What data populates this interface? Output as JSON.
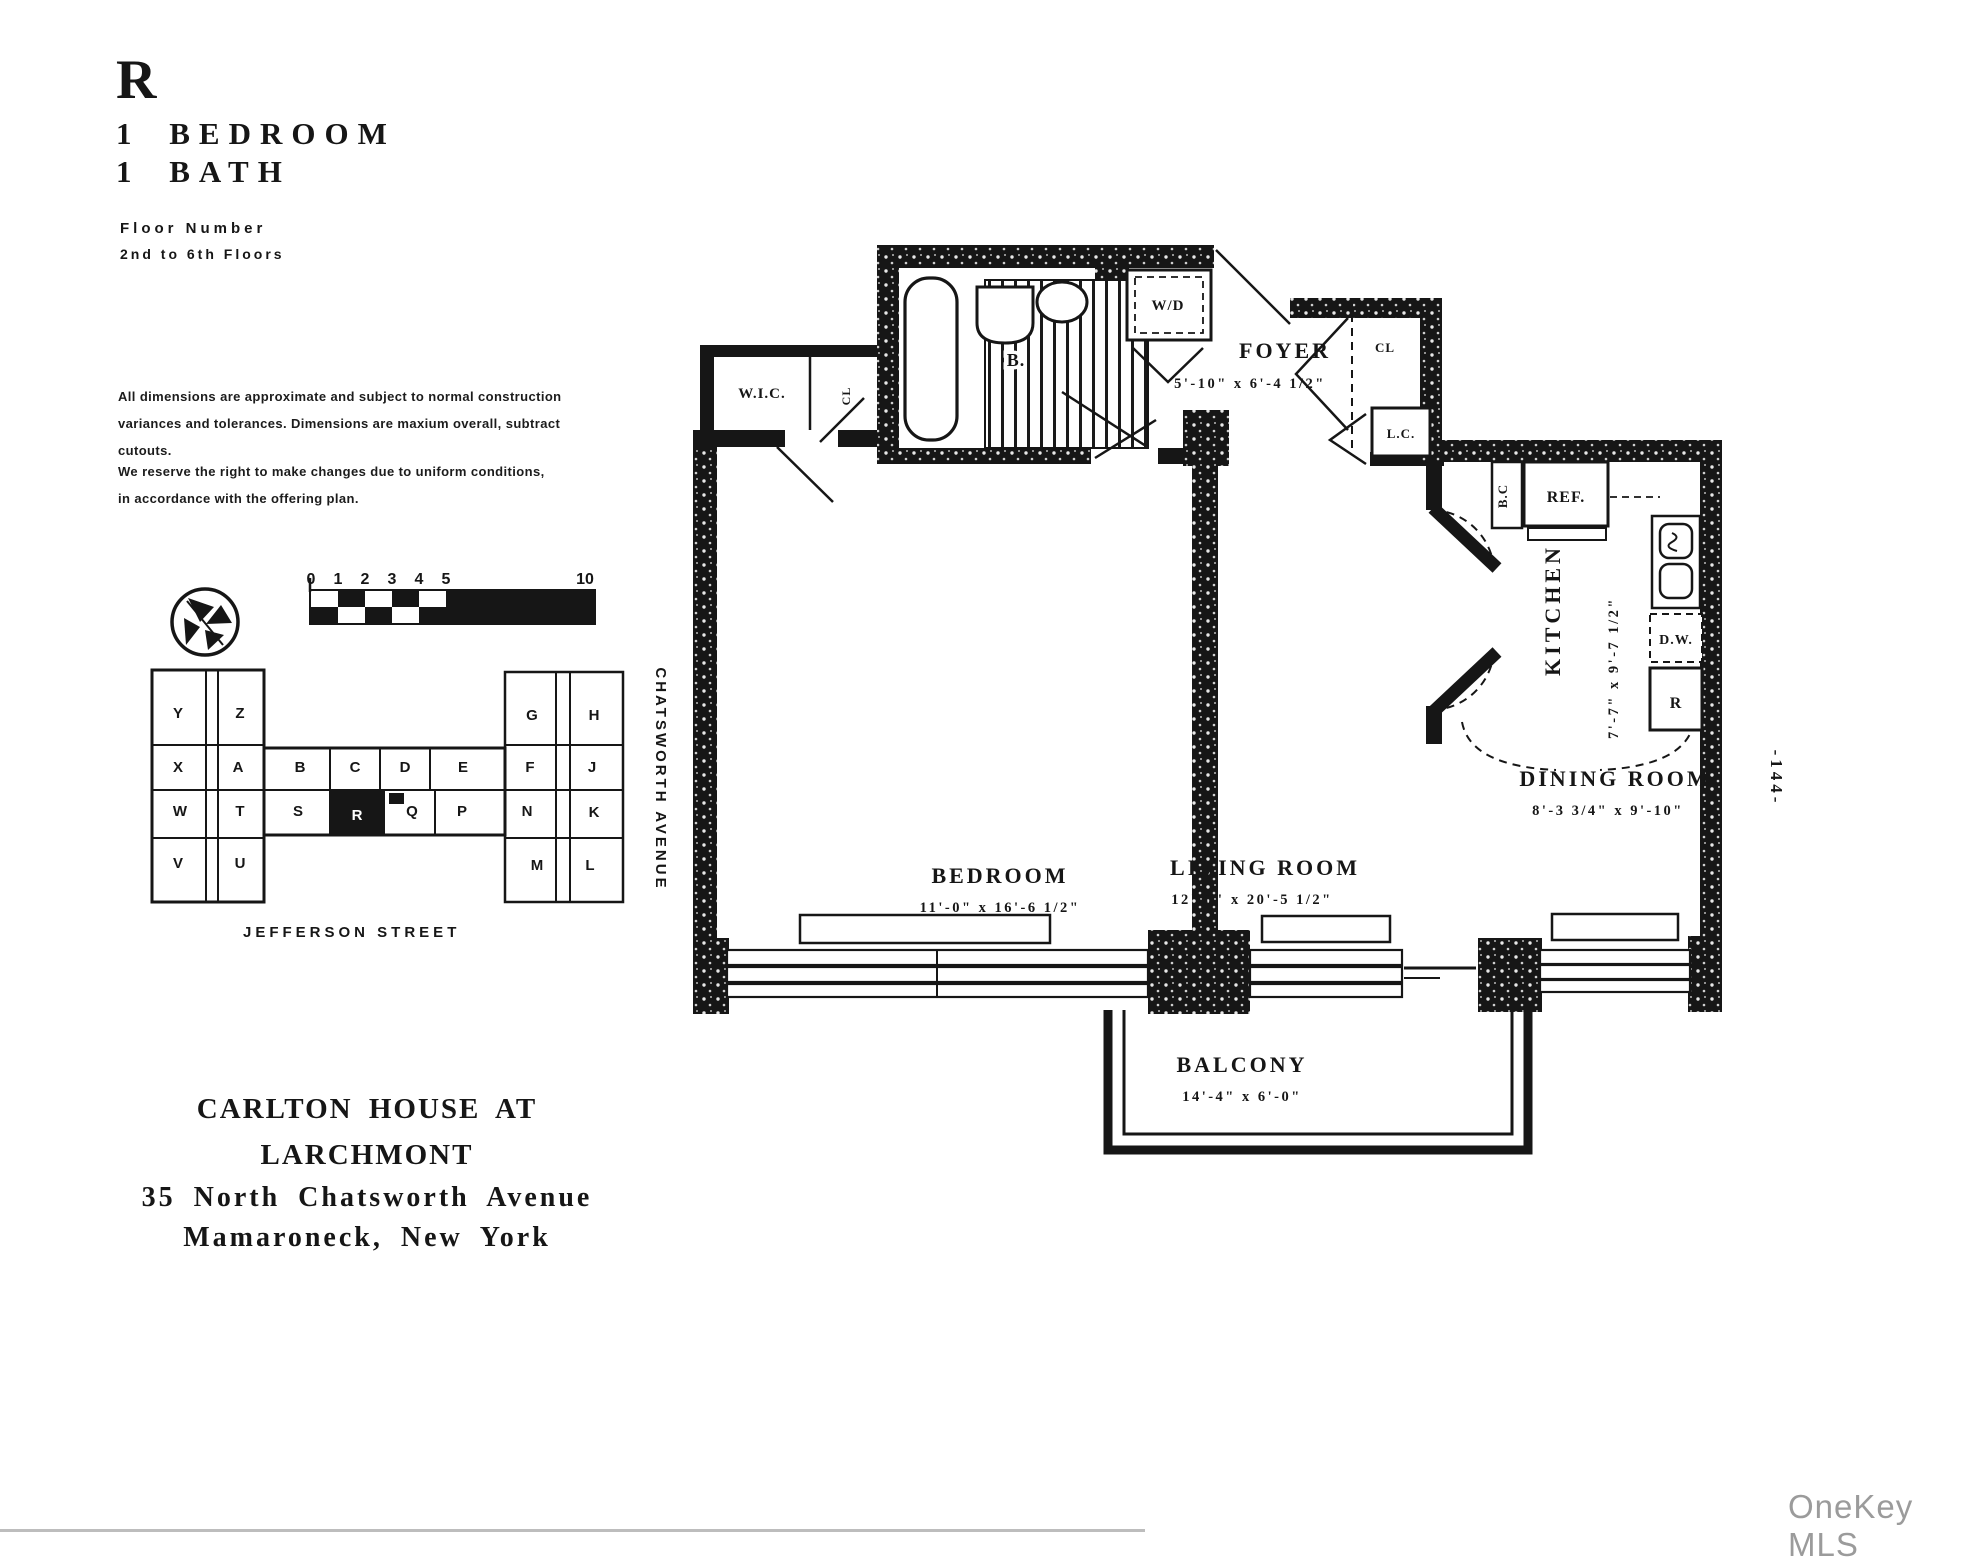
{
  "header": {
    "unit_letter": "R",
    "line1": "1 BEDROOM",
    "line2": "1 BATH"
  },
  "floor_info": {
    "label": "Floor Number",
    "value": "2nd to 6th Floors"
  },
  "disclaimers": {
    "p1": "All dimensions are approximate and subject to normal construction\nvariances and tolerances. Dimensions are maxium overall, subtract\ncutouts.",
    "p2": "We reserve the right to make changes due to uniform conditions,\nin accordance with the offering plan."
  },
  "scale_bar": {
    "ticks": [
      "0",
      "1",
      "2",
      "3",
      "4",
      "5",
      "10"
    ]
  },
  "site_plan": {
    "street_label": "JEFFERSON STREET",
    "avenue_label": "CHATSWORTH AVENUE",
    "highlighted_unit": "R",
    "letters": [
      "Y",
      "Z",
      "X",
      "A",
      "B",
      "C",
      "D",
      "E",
      "F",
      "W",
      "T",
      "S",
      "Q",
      "P",
      "N",
      "V",
      "U",
      "G",
      "H",
      "J",
      "K",
      "M",
      "L"
    ]
  },
  "address": {
    "building": "CARLTON HOUSE AT LARCHMONT",
    "line1": "35 North Chatsworth Avenue",
    "line2": "Mamaroneck, New York"
  },
  "rooms": {
    "foyer": {
      "name": "FOYER",
      "dims": "5'-10\" x 6'-4 1/2\""
    },
    "kitchen": {
      "name": "KITCHEN",
      "dims": "7'-7\" x 9'-7 1/2\""
    },
    "dining_room": {
      "name": "DINING ROOM",
      "dims": "8'-3 3/4\" x 9'-10\""
    },
    "living_room": {
      "name": "LIVING ROOM",
      "dims": "12'-0\" x 20'-5 1/2\""
    },
    "bedroom": {
      "name": "BEDROOM",
      "dims": "11'-0\" x 16'-6 1/2\""
    },
    "balcony": {
      "name": "BALCONY",
      "dims": "14'-4\" x 6'-0\""
    }
  },
  "fixtures": {
    "washer_dryer": "W/D",
    "bath": "B.",
    "walk_in_closet": "W.I.C.",
    "closet": "CL",
    "closet2": "CL",
    "linen_closet": "L.C.",
    "base_cabinet": "B.C",
    "refrigerator": "REF.",
    "dishwasher": "D.W.",
    "range": "R"
  },
  "page_number": "-144-",
  "watermark": "OneKey MLS",
  "colors": {
    "ink": "#161616",
    "paper": "#ffffff",
    "watermark_gray": "#9b9b9b"
  }
}
